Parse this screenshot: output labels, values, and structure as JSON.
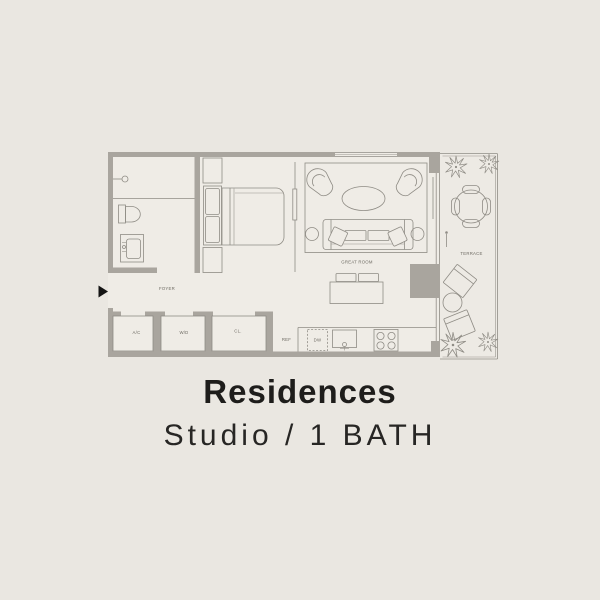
{
  "colors": {
    "background": "#eae7e1",
    "floor": "#efece6",
    "terrace_floor": "#edeae4",
    "wall": "#a9a59e",
    "line": "#8f8c85",
    "label": "#6e6b63",
    "title": "#1e1d1b",
    "subtitle": "#272624",
    "entry_arrow": "#141414"
  },
  "floorplan": {
    "rooms": {
      "foyer": "FOYER",
      "great_room": "GREAT ROOM",
      "terrace": "TERRACE"
    },
    "closets": {
      "ac": "A/C",
      "wd": "W/D",
      "cl": "CL."
    },
    "kitchen": {
      "ref": "REF",
      "dw": "DW"
    }
  },
  "caption": {
    "title": "Residences",
    "subtitle": "Studio / 1 BATH"
  }
}
